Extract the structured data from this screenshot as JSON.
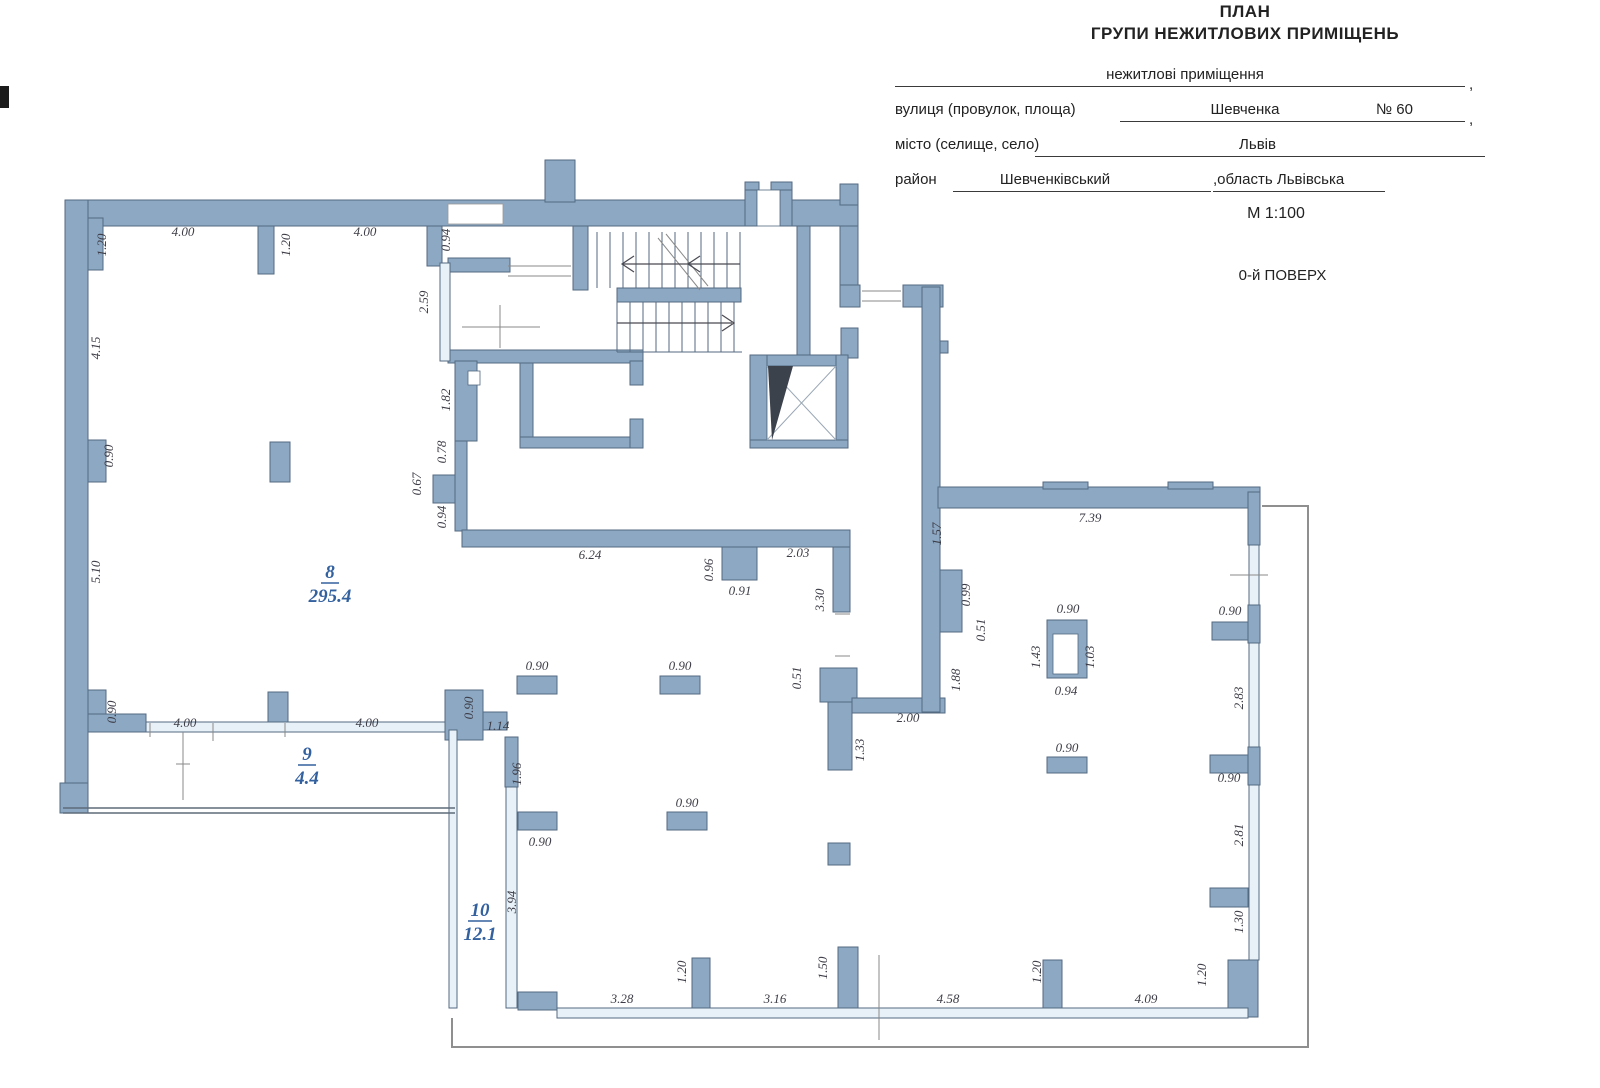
{
  "header": {
    "title_line1": "ПЛАН",
    "title_line2": "ГРУПИ НЕЖИТЛОВИХ ПРИМІЩЕНЬ",
    "premises_line": "нежитлові приміщення",
    "street_label": "вулиця (провулок, площа)",
    "street_value": "Шевченка",
    "street_number": "№ 60",
    "city_label": "місто (селище, село)",
    "city_value": "Львів",
    "district_label": "район",
    "district_value": "Шевченківський",
    "region_value": ",область Львівська",
    "scale": "М 1:100",
    "floor": "0-й ПОВЕРХ",
    "comma": ","
  },
  "rooms": [
    {
      "number": "8",
      "area": "295.4"
    },
    {
      "number": "9",
      "area": "4.4"
    },
    {
      "number": "10",
      "area": "12.1"
    }
  ],
  "dims": [
    "4.00",
    "4.00",
    "6.24",
    "2.03",
    "0.91",
    "7.39",
    "0.90",
    "0.90",
    "0.90",
    "0.94",
    "0.90",
    "0.90",
    "0.90",
    "2.00",
    "0.90",
    "3.28",
    "3.16",
    "4.58",
    "4.09",
    "4.00",
    "4.00",
    "1.14",
    "0.90",
    "1.20",
    "4.15",
    "0.90",
    "5.10",
    "0.90",
    "1.20",
    "0.94",
    "2.59",
    "1.82",
    "0.78",
    "0.67",
    "0.94",
    "0.96",
    "3.30",
    "0.51",
    "1.33",
    "1.57",
    "0.99",
    "0.51",
    "1.88",
    "1.43",
    "1.03",
    "2.83",
    "2.81",
    "1.30",
    "1.20",
    "1.20",
    "1.50",
    "1.20",
    "1.96",
    "3.94",
    "0.90"
  ],
  "colors": {
    "wall_fill": "#8da8c3",
    "wall_stroke": "#546a81",
    "window_fill": "#e9f1f8",
    "room_label": "#33619f",
    "dim_text": "#3d3d47",
    "boundary_line": "#8f8f8f",
    "header_text": "#222222"
  }
}
